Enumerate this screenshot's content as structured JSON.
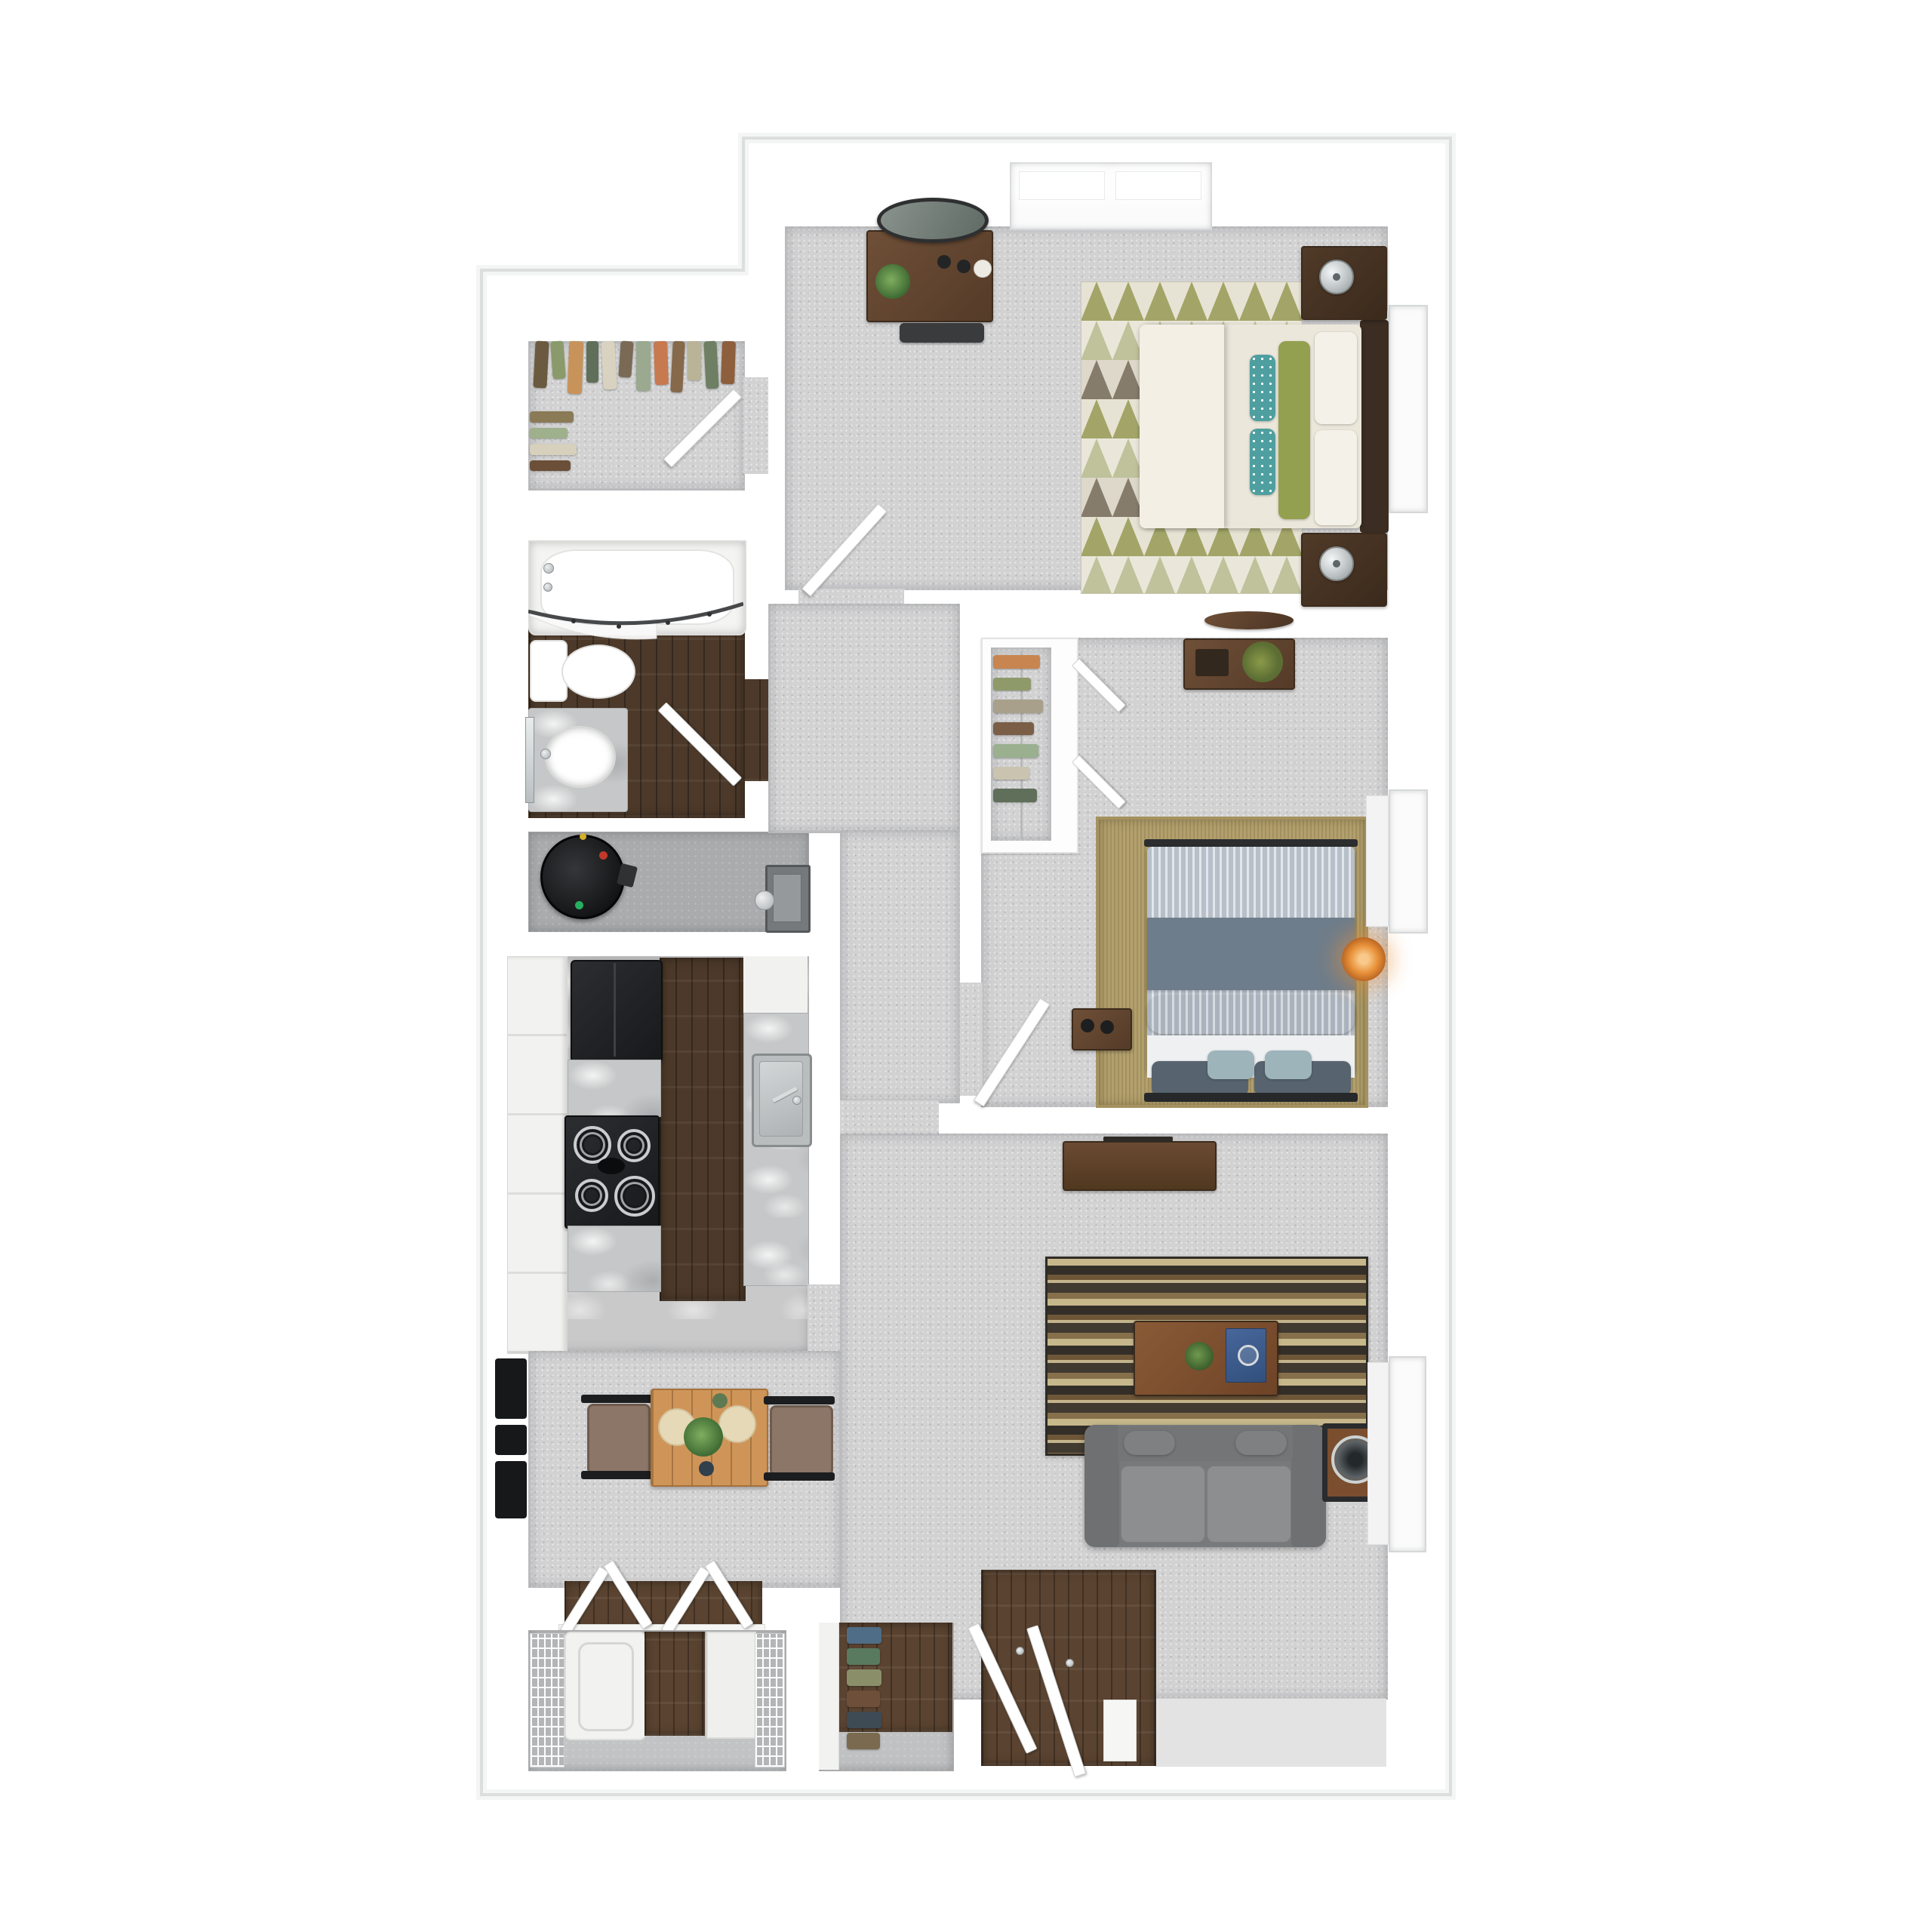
{
  "scene": {
    "kind": "3D top-down apartment floor plan rendering",
    "text_visible_on_image": false,
    "background": "#ffffff"
  },
  "palette": {
    "walls": "#ffffff",
    "exterior_outline": "#c2c5c6",
    "carpet": "#d2d2d3",
    "dark_wood_floor": "#4c3929",
    "entry_wood_floor": "#5a4330",
    "marble_counter": "#c6c7c8",
    "appliance_black": "#1d1f21",
    "sofa_gray": "#7d7f80",
    "accent_green_pillow": "#93a04f",
    "accent_teal_pillow": "#4f9fa0",
    "accent_blue_pillow": "#9cb4ba",
    "walnut_furniture": "#5d4430",
    "jute_rug": "#b3a06c",
    "lamp_glow_orange": "#e8913a"
  },
  "rooms": [
    {
      "id": "master-bedroom",
      "name": "Master Bedroom",
      "furniture": [
        "dresser with oval mirror",
        "houseplant",
        "bench",
        "double top window",
        "side window",
        "queen bed with cream bedding",
        "green lumbar pillow",
        "teal accent pillows",
        "two walnut nightstands",
        "two silver lamps",
        "triangle pattern area rug",
        "hinged entry door"
      ]
    },
    {
      "id": "walk-in-closet",
      "name": "Walk-in Closet",
      "furniture": [
        "hanging clothes on two rods",
        "hinged door"
      ]
    },
    {
      "id": "bathroom",
      "name": "Bathroom",
      "furniture": [
        "bathtub with curved shower rod and curtain",
        "toilet",
        "marble vanity with oval sink",
        "wall mirror",
        "hinged door"
      ]
    },
    {
      "id": "utility-closet",
      "name": "Utility Closet",
      "furniture": [
        "water heater",
        "electrical panel"
      ]
    },
    {
      "id": "hallway",
      "name": "Hallway",
      "furniture": []
    },
    {
      "id": "kitchen",
      "name": "Kitchen",
      "furniture": [
        "white cabinet run",
        "refrigerator",
        "electric coil range",
        "marble counters",
        "stainless sink with faucet",
        "dark wood floor strip"
      ]
    },
    {
      "id": "bedroom-2",
      "name": "Bedroom 2",
      "furniture": [
        "reach-in closet with hanging clothes and two doors",
        "desk with plant and tray",
        "oval wall shelf",
        "queen bed with striped blue bedding",
        "small nightstand with speakers",
        "orange glow lamp",
        "jute rug",
        "side window",
        "hinged door"
      ]
    },
    {
      "id": "living-room",
      "name": "Living Room",
      "furniture": [
        "media console",
        "striped area rug",
        "coffee table with plant and blue book",
        "gray loveseat sofa",
        "side table with round fan clock",
        "side window"
      ]
    },
    {
      "id": "dining-area",
      "name": "Dining Area",
      "furniture": [
        "wood dining table",
        "two chairs",
        "place settings with plates and centerpiece plant",
        "wall mounted black panels"
      ]
    },
    {
      "id": "laundry-closet",
      "name": "Laundry Closet",
      "furniture": [
        "bifold doors",
        "wire shelving",
        "dryer",
        "white storage cabinet"
      ]
    },
    {
      "id": "shoe-closet",
      "name": "Shoe Closet",
      "furniture": [
        "shoe rack with six pairs"
      ]
    },
    {
      "id": "entry",
      "name": "Entry",
      "furniture": [
        "front door",
        "closet door",
        "wood floor",
        "threshold"
      ]
    }
  ]
}
